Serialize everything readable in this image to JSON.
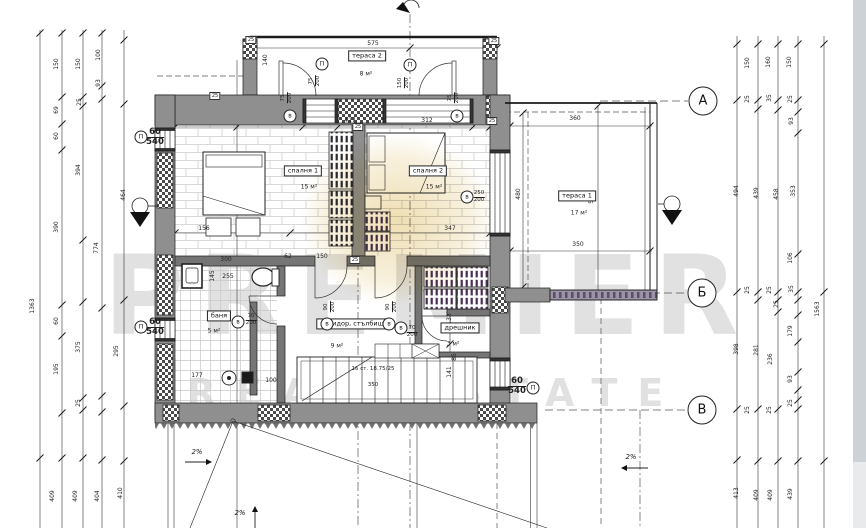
{
  "watermark": {
    "line1": "PREMIER",
    "line2": "REAL ESTATE"
  },
  "colors": {
    "wall": "#8f8f8f",
    "wall_dark": "#757575",
    "accent_blob": "#d8b14a",
    "wardrobe_stripe": "#2a2a33",
    "closet_stripe": "#472f55"
  },
  "grid_bubbles": [
    {
      "label": "А",
      "x": 703,
      "y": 101
    },
    {
      "label": "Б",
      "x": 702,
      "y": 293
    },
    {
      "label": "В",
      "x": 702,
      "y": 410
    }
  ],
  "rooms": [
    {
      "name": "тераса 2",
      "area": "8 м²",
      "x": 367,
      "y": 56,
      "ax": 366,
      "ay": 74
    },
    {
      "name": "спалня 1",
      "area": "15 м²",
      "x": 303,
      "y": 171,
      "ax": 309,
      "ay": 187
    },
    {
      "name": "спалня 2",
      "area": "15 м²",
      "x": 428,
      "y": 171,
      "ax": 434,
      "ay": 187
    },
    {
      "name": "тераса 1",
      "area": "17 м²",
      "x": 577,
      "y": 196,
      "ax": 579,
      "ay": 213
    },
    {
      "name": "баня",
      "area": "5 м²",
      "x": 219,
      "y": 316,
      "ax": 214,
      "ay": 331
    },
    {
      "name": "коридор, стълбище",
      "area": "9 м²",
      "x": 354,
      "y": 324,
      "ax": 337,
      "ay": 346
    },
    {
      "name": "дрешник",
      "area": "3 м²",
      "x": 460,
      "y": 328,
      "ax": 453,
      "ay": 344
    }
  ],
  "stairs": {
    "note": "16 ст. 18.75/25",
    "width_label": "350"
  },
  "openings": [
    {
      "sym": "П",
      "num": "75/200",
      "x": 315,
      "y": 81,
      "r": 1,
      "cx": 322,
      "cy": 64,
      "big": 0
    },
    {
      "sym": "П",
      "num": "150/200",
      "x": 404,
      "y": 83,
      "r": 1,
      "cx": 410,
      "cy": 65,
      "big": 0
    },
    {
      "sym": "в",
      "num": "75/200",
      "x": 287,
      "y": 98,
      "r": 1,
      "cx": 290,
      "cy": 116,
      "big": 0
    },
    {
      "sym": "в",
      "num": "75/200",
      "x": 454,
      "y": 98,
      "r": 1,
      "cx": 457,
      "cy": 116,
      "big": 0
    },
    {
      "sym": "в",
      "num": "250/200",
      "x": 479,
      "y": 197,
      "r": 0,
      "cx": 467,
      "cy": 197,
      "big": 0
    },
    {
      "sym": "в",
      "num": "90/200",
      "x": 330,
      "y": 307,
      "r": 1,
      "cx": 327,
      "cy": 324,
      "big": 0
    },
    {
      "sym": "в",
      "num": "90/200",
      "x": 392,
      "y": 307,
      "r": 1,
      "cx": 389,
      "cy": 324,
      "big": 0
    },
    {
      "sym": "в",
      "num": "70/200",
      "x": 412,
      "y": 332,
      "r": 0,
      "cx": 401,
      "cy": 328,
      "big": 0
    },
    {
      "sym": "в",
      "num": "70/200",
      "x": 251,
      "y": 320,
      "r": 0,
      "cx": 238,
      "cy": 322,
      "big": 0
    },
    {
      "sym": "П",
      "num": "60/540",
      "x": 155,
      "y": 137,
      "r": 0,
      "cx": 141,
      "cy": 137,
      "big": 1
    },
    {
      "sym": "П",
      "num": "60/540",
      "x": 155,
      "y": 327,
      "r": 0,
      "cx": 141,
      "cy": 327,
      "big": 1
    },
    {
      "sym": "П",
      "num": "60/540",
      "x": 517,
      "y": 386,
      "r": 0,
      "cx": 533,
      "cy": 388,
      "big": 1
    }
  ],
  "dim_labels": [
    {
      "t": "150",
      "x": 57,
      "y": 64,
      "r": 1
    },
    {
      "t": "150",
      "x": 79,
      "y": 64,
      "r": 1
    },
    {
      "t": "100",
      "x": 99,
      "y": 55,
      "r": 1
    },
    {
      "t": "93",
      "x": 99,
      "y": 83,
      "r": 1
    },
    {
      "t": "25",
      "x": 80,
      "y": 102,
      "r": 1
    },
    {
      "t": "69",
      "x": 57,
      "y": 110,
      "r": 1
    },
    {
      "t": "60",
      "x": 57,
      "y": 136,
      "r": 1
    },
    {
      "t": "394",
      "x": 79,
      "y": 170,
      "r": 1
    },
    {
      "t": "774",
      "x": 97,
      "y": 248,
      "r": 1
    },
    {
      "t": "390",
      "x": 57,
      "y": 227,
      "r": 1
    },
    {
      "t": "464",
      "x": 124,
      "y": 195,
      "r": 1
    },
    {
      "t": "1363",
      "x": 33,
      "y": 306,
      "r": 1
    },
    {
      "t": "60",
      "x": 57,
      "y": 321,
      "r": 1
    },
    {
      "t": "375",
      "x": 79,
      "y": 347,
      "r": 1
    },
    {
      "t": "195",
      "x": 57,
      "y": 369,
      "r": 1
    },
    {
      "t": "295",
      "x": 117,
      "y": 351,
      "r": 1
    },
    {
      "t": "25",
      "x": 79,
      "y": 403,
      "r": 1
    },
    {
      "t": "409",
      "x": 53,
      "y": 496,
      "r": 1
    },
    {
      "t": "409",
      "x": 76,
      "y": 496,
      "r": 1
    },
    {
      "t": "404",
      "x": 98,
      "y": 496,
      "r": 1
    },
    {
      "t": "410",
      "x": 121,
      "y": 493,
      "r": 1
    },
    {
      "t": "150",
      "x": 748,
      "y": 63,
      "r": 1
    },
    {
      "t": "160",
      "x": 769,
      "y": 62,
      "r": 1
    },
    {
      "t": "150",
      "x": 790,
      "y": 62,
      "r": 1
    },
    {
      "t": "25",
      "x": 748,
      "y": 99,
      "r": 1
    },
    {
      "t": "35",
      "x": 770,
      "y": 98,
      "r": 1
    },
    {
      "t": "25",
      "x": 791,
      "y": 99,
      "r": 1
    },
    {
      "t": "93",
      "x": 792,
      "y": 121,
      "r": 1
    },
    {
      "t": "494",
      "x": 737,
      "y": 191,
      "r": 1
    },
    {
      "t": "439",
      "x": 757,
      "y": 193,
      "r": 1
    },
    {
      "t": "458",
      "x": 777,
      "y": 194,
      "r": 1
    },
    {
      "t": "353",
      "x": 794,
      "y": 191,
      "r": 1
    },
    {
      "t": "106",
      "x": 791,
      "y": 258,
      "r": 1
    },
    {
      "t": "25",
      "x": 748,
      "y": 290,
      "r": 1
    },
    {
      "t": "25",
      "x": 770,
      "y": 290,
      "r": 1
    },
    {
      "t": "35",
      "x": 792,
      "y": 289,
      "r": 1
    },
    {
      "t": "25",
      "x": 777,
      "y": 304,
      "r": 1
    },
    {
      "t": "179",
      "x": 791,
      "y": 331,
      "r": 1
    },
    {
      "t": "1563",
      "x": 818,
      "y": 309,
      "r": 1
    },
    {
      "t": "398",
      "x": 737,
      "y": 349,
      "r": 1
    },
    {
      "t": "281",
      "x": 757,
      "y": 350,
      "r": 1
    },
    {
      "t": "236",
      "x": 771,
      "y": 359,
      "r": 1
    },
    {
      "t": "93",
      "x": 791,
      "y": 379,
      "r": 1
    },
    {
      "t": "25",
      "x": 748,
      "y": 410,
      "r": 1
    },
    {
      "t": "25",
      "x": 770,
      "y": 410,
      "r": 1
    },
    {
      "t": "25",
      "x": 791,
      "y": 403,
      "r": 1
    },
    {
      "t": "413",
      "x": 737,
      "y": 493,
      "r": 1
    },
    {
      "t": "409",
      "x": 757,
      "y": 495,
      "r": 1
    },
    {
      "t": "409",
      "x": 771,
      "y": 495,
      "r": 1
    },
    {
      "t": "439",
      "x": 791,
      "y": 494,
      "r": 1
    },
    {
      "t": "575",
      "x": 373,
      "y": 44,
      "r": 0
    },
    {
      "t": "140",
      "x": 266,
      "y": 60,
      "r": 1
    },
    {
      "t": "427",
      "x": 350,
      "y": 121,
      "r": 0
    },
    {
      "t": "312",
      "x": 427,
      "y": 121,
      "r": 0
    },
    {
      "t": "360",
      "x": 575,
      "y": 119,
      "r": 0
    },
    {
      "t": "549",
      "x": 592,
      "y": 198,
      "r": 1
    },
    {
      "t": "480",
      "x": 519,
      "y": 194,
      "r": 1
    },
    {
      "t": "350",
      "x": 578,
      "y": 245,
      "r": 0
    },
    {
      "t": "347",
      "x": 450,
      "y": 229,
      "r": 0
    },
    {
      "t": "156",
      "x": 204,
      "y": 229,
      "r": 0
    },
    {
      "t": "300",
      "x": 226,
      "y": 260,
      "r": 0
    },
    {
      "t": "62",
      "x": 288,
      "y": 257,
      "r": 0
    },
    {
      "t": "150",
      "x": 322,
      "y": 257,
      "r": 0
    },
    {
      "t": "255",
      "x": 228,
      "y": 277,
      "r": 0
    },
    {
      "t": "145",
      "x": 213,
      "y": 276,
      "r": 1
    },
    {
      "t": "177",
      "x": 197,
      "y": 376,
      "r": 0
    },
    {
      "t": "100",
      "x": 271,
      "y": 381,
      "r": 0
    },
    {
      "t": "133",
      "x": 450,
      "y": 319,
      "r": 1
    },
    {
      "t": "141",
      "x": 450,
      "y": 372,
      "r": 1
    },
    {
      "t": "85",
      "x": 455,
      "y": 357,
      "r": 1
    },
    {
      "t": "25",
      "x": 215,
      "y": 96,
      "r": 0,
      "b": 1
    },
    {
      "t": "25",
      "x": 251,
      "y": 40,
      "r": 0,
      "b": 1
    },
    {
      "t": "25",
      "x": 494,
      "y": 41,
      "r": 0,
      "b": 1
    },
    {
      "t": "25",
      "x": 492,
      "y": 121,
      "r": 0,
      "b": 1
    },
    {
      "t": "25",
      "x": 355,
      "y": 260,
      "r": 0,
      "b": 1
    },
    {
      "t": "25",
      "x": 358,
      "y": 127,
      "r": 0,
      "b": 1
    }
  ],
  "slope_labels": [
    {
      "text": "2%",
      "x": 197,
      "y": 452
    },
    {
      "text": "2%",
      "x": 631,
      "y": 457
    },
    {
      "text": "2%",
      "x": 240,
      "y": 513
    }
  ]
}
